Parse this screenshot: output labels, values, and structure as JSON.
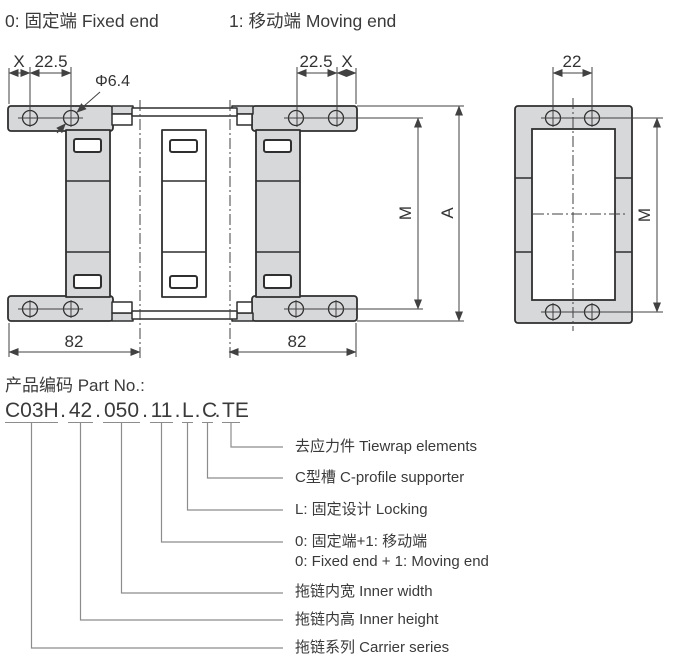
{
  "title": {
    "left": "0: 固定端 Fixed end",
    "right": "1: 移动端 Moving end"
  },
  "dims": {
    "x_left": "X",
    "w_left": "22.5",
    "hole_dia": "Φ6.4",
    "w_right": "22.5",
    "x_right": "X",
    "m_front": "M",
    "a_front": "A",
    "pitch_left": "82",
    "pitch_right": "82",
    "side_width": "22",
    "m_side": "M"
  },
  "part_no": {
    "label": "产品编码 Part No.:",
    "dot": ".",
    "segments": [
      "C03H",
      "42",
      "050",
      "11",
      "L",
      "C",
      "TE"
    ]
  },
  "legend": [
    {
      "text": "去应力件 Tiewrap elements"
    },
    {
      "text": "C型槽 C-profile supporter"
    },
    {
      "text": "L: 固定设计 Locking"
    },
    {
      "text": "0: 固定端+1: 移动端",
      "text2": "0: Fixed end + 1: Moving end"
    },
    {
      "text": "拖链内宽 Inner width"
    },
    {
      "text": "拖链内高 Inner height"
    },
    {
      "text": "拖链系列 Carrier series"
    }
  ],
  "colors": {
    "part_fill": "#d7d8da",
    "outline": "#2f2f2f",
    "dim_line": "#414141",
    "connector_line": "#8c8c8c"
  }
}
